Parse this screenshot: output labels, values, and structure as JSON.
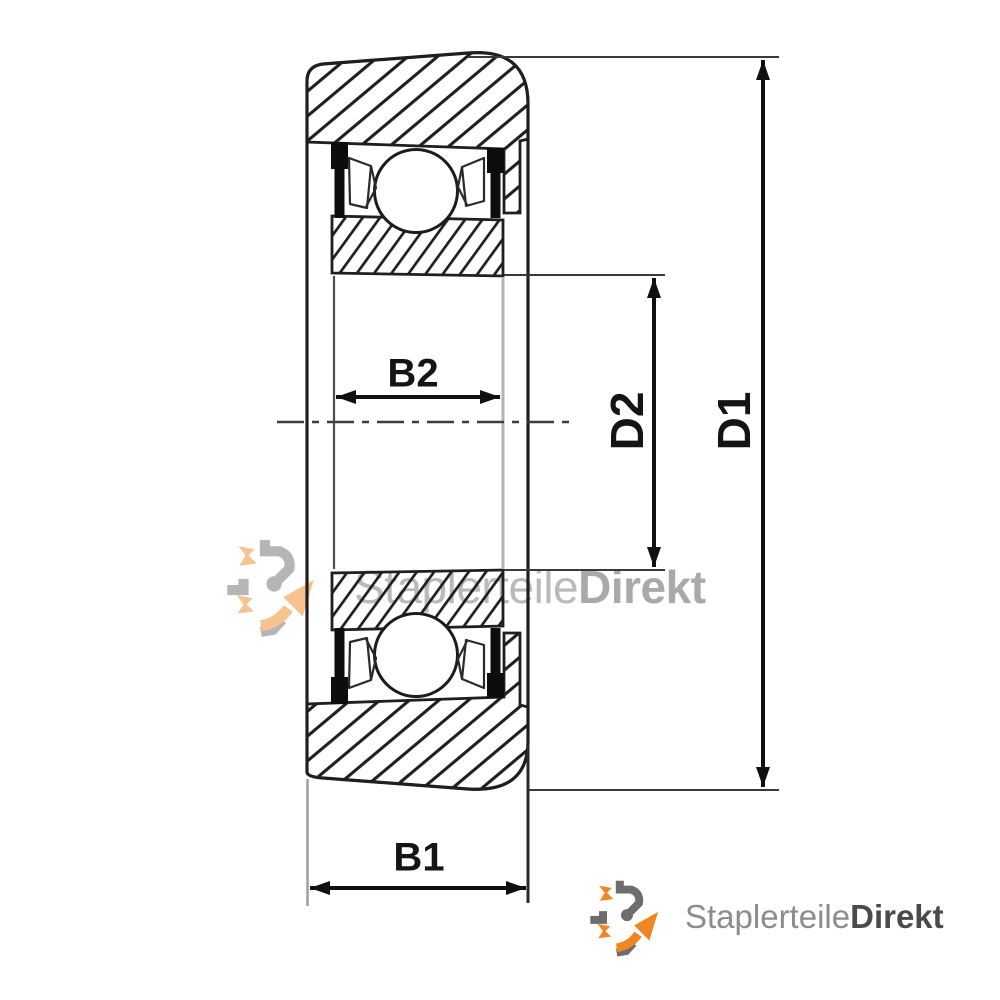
{
  "diagram": {
    "type": "bearing cross-section technical drawing",
    "dimensions": {
      "inner_width_label": "B2",
      "outer_width_label": "B1",
      "inner_diameter_label": "D2",
      "outer_diameter_label": "D1"
    }
  },
  "watermark": {
    "brand_regular": "Staplerteile",
    "brand_bold": "Direkt"
  },
  "footer_logo": {
    "brand_regular": "Staplerteile",
    "brand_bold": "Direkt"
  },
  "colors": {
    "line_black": "#1c1c1c",
    "accent_orange": "#ee8722",
    "logo_gray": "#8c8c8c",
    "logo_dark": "#4a4a4a",
    "watermark_gray": "#9a9a9a"
  }
}
